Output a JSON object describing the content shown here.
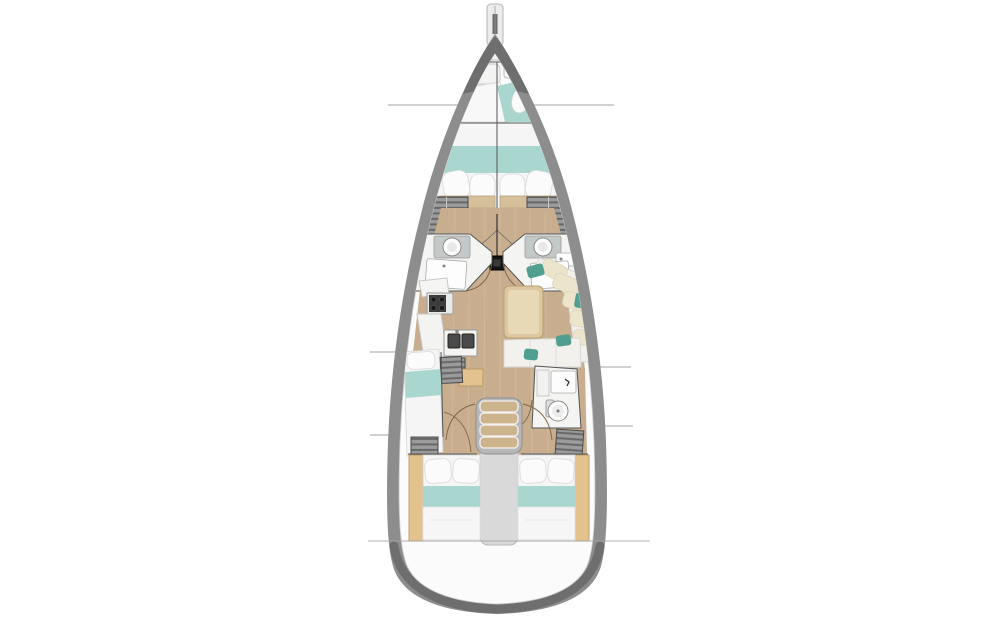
{
  "diagram": {
    "type": "yacht-interior-floor-plan",
    "orientation": "bow-up, top-down view",
    "zones": [
      {
        "id": "bowsprit",
        "label": "bowsprit with anchor roller"
      },
      {
        "id": "anchor-locker",
        "label": "anchor locker"
      },
      {
        "id": "forepeak-berth",
        "label": "forepeak berth with seat and cabinet"
      },
      {
        "id": "forward-cabin",
        "label": "forward V-berth cabin, twin berths, 4 pillows, teal blanket band"
      },
      {
        "id": "wardrobe-forward-port",
        "label": "port louvered wardrobe"
      },
      {
        "id": "wardrobe-forward-starboard",
        "label": "starboard louvered wardrobe"
      },
      {
        "id": "head-forward-port",
        "label": "forward port head: toilet and vanity"
      },
      {
        "id": "head-forward-starboard",
        "label": "forward starboard head: toilet, vanity and sink"
      },
      {
        "id": "mast",
        "label": "mast step with shroud rigging"
      },
      {
        "id": "galley-port",
        "label": "port galley: stove with burners, double sink, louvered fridge, cabinet"
      },
      {
        "id": "dinette-starboard",
        "label": "starboard U-shaped dinette with table and teal accent pillows"
      },
      {
        "id": "midship-cabin-port",
        "label": "port midship single berth with lockers"
      },
      {
        "id": "head-aft-starboard",
        "label": "aft starboard head: shower sink unit and toilet"
      },
      {
        "id": "companionway-stairs",
        "label": "companionway stairs, 4 treads, landing to engine box"
      },
      {
        "id": "aft-cabin-port",
        "label": "port aft double cabin, 2 pillows, teal band"
      },
      {
        "id": "aft-cabin-starboard",
        "label": "starboard aft double cabin, 2 pillows, teal band"
      },
      {
        "id": "transom",
        "label": "rounded stern transom"
      }
    ],
    "divider_lines": {
      "bow_y": 105,
      "port_mid_y": 352,
      "port_aft_y": 435,
      "starboard_mid_y": 367,
      "starboard_aft_y": 426,
      "stern_y": 541
    }
  },
  "colors": {
    "hull": "#8d8d8d",
    "hullDark": "#6e6e6e",
    "deck": "#fbfbfb",
    "wood": "#c8ae8e",
    "woodLine": "#d3bb9b",
    "teal": "#a9d6ce",
    "accent": "#4f9e8f",
    "cream": "#ece4cb",
    "beddingWhite": "#f4f5f4",
    "locker": "#9b9b9b",
    "slat": "#5f5f5f",
    "cabinet": "#e3c28d",
    "tableTan": "#dcc7a0",
    "tableInner": "#e8d9b6",
    "wall": "#555555",
    "door": "#7d6448",
    "line": "#a3a3a3",
    "fixture": "#c5c8c8",
    "stove": "#3b3b3b",
    "tread": "#cdb48d",
    "frame": "#b7b7b7",
    "landing": "#d9d9d9"
  }
}
